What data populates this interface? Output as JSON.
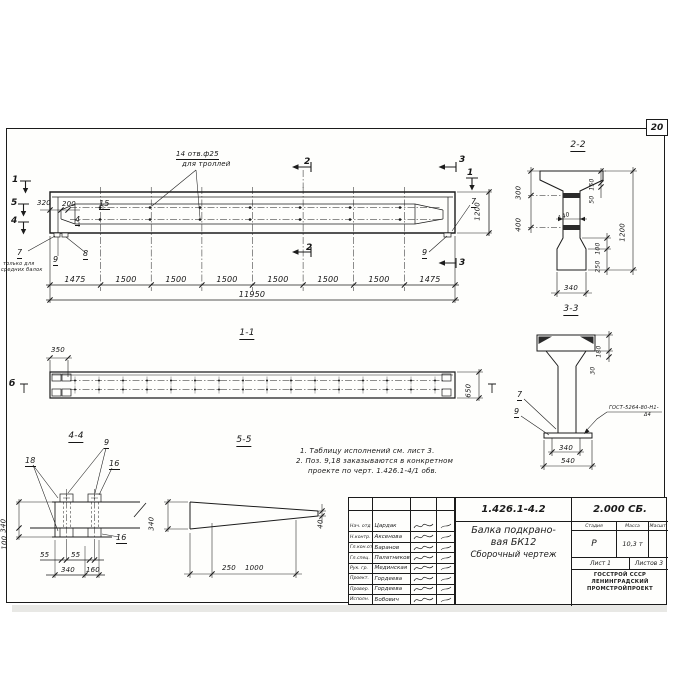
{
  "page": {
    "sheet_number": "20"
  },
  "elevation": {
    "holes_note_line1": "14 отв.ф25",
    "holes_note_line2": "для троллей",
    "marker_1_left": "1",
    "marker_5": "5",
    "marker_4": "4",
    "marker_1_right": "1",
    "marker_2_top": "2",
    "marker_2_bottom": "2",
    "marker_3_top": "3",
    "marker_3_bottom": "3",
    "dim_320": "320",
    "dim_200": "200",
    "pos_15": "15",
    "pos_4": "4",
    "pos_7_left": "7",
    "pos_9_left": "9",
    "pos_8": "8",
    "pos_7_right": "7",
    "pos_9_right": "9",
    "note_line1": "только для",
    "note_line2": "средних балок",
    "dims_bottom": [
      "1475",
      "1500",
      "1500",
      "1500",
      "1500",
      "1500",
      "1500",
      "1475"
    ],
    "dim_total": "11950",
    "dim_height": "1200"
  },
  "section11": {
    "title": "1-1",
    "dim_350": "350",
    "dim_650": "650",
    "marker_b_left": "б"
  },
  "section22": {
    "title": "2-2",
    "dim_300": "300",
    "dim_400": "400",
    "dim_150": "150",
    "dim_50": "50",
    "dim_140": "140",
    "dim_1200": "1200",
    "dim_100": "100",
    "dim_250": "250",
    "dim_340": "340"
  },
  "section33": {
    "title": "3-3",
    "dim_180": "180",
    "dim_30": "30",
    "pos_7": "7",
    "pos_9": "9",
    "weld_note_line1": "ГОСТ-5264-80-Н1-",
    "weld_note_line2": "Δ4",
    "dim_340": "340",
    "dim_540": "540"
  },
  "section44": {
    "title": "4-4",
    "pos_9": "9",
    "pos_18": "18",
    "pos_16_top": "16",
    "pos_16_bottom": "16",
    "dim_340_left": "340",
    "dim_100": "100",
    "dim_55_1": "55",
    "dim_55_2": "55",
    "dim_340_bottom": "340",
    "dim_160": "160"
  },
  "section55": {
    "title": "5-5",
    "dim_340": "340",
    "dim_40": "40",
    "dim_250": "250",
    "dim_1000": "1000"
  },
  "notes": {
    "line1": "1. Таблицу исполнений см. лист 3.",
    "line2": "2. Поз. 9,18 заказываются в конкретном",
    "line3": "проекте по черт. 1.426.1-4/1 обв."
  },
  "titleblock": {
    "doc_number": "1.426.1-4.2",
    "doc_series": "2.000 СБ.",
    "title_line1": "Балка подкрано-",
    "title_line2": "вая БК12",
    "title_line3": "Сборочный чертеж",
    "col_stage": "Стадия",
    "col_mass": "Масса",
    "col_scale": "Масшт.",
    "stage_value": "Р",
    "mass_value": "10,3 т",
    "sheet_label": "Лист 1",
    "sheets_label": "Листов 3",
    "org_line1": "ГОССТРОЙ СССР",
    "org_line2": "ЛЕНИНГРАДСКИЙ",
    "org_line3": "ПРОМСТРОЙПРОЕКТ",
    "rows": [
      {
        "role": "Нач. отд",
        "name": "Цардак"
      },
      {
        "role": "Н.контр.",
        "name": "Аксенова"
      },
      {
        "role": "Гл.кон.отд",
        "name": "Баранов"
      },
      {
        "role": "Гл.спец.",
        "name": "Палатников"
      },
      {
        "role": "Рук. гр.",
        "name": "Мединская"
      },
      {
        "role": "Проект.",
        "name": "Гордеева"
      },
      {
        "role": "Провер.",
        "name": "Гордеева"
      },
      {
        "role": "Исполн.",
        "name": "Бобович"
      }
    ]
  },
  "colors": {
    "ink": "#1b1b1b",
    "paper": "#fefefc",
    "hatch": "#2a2a2a"
  }
}
